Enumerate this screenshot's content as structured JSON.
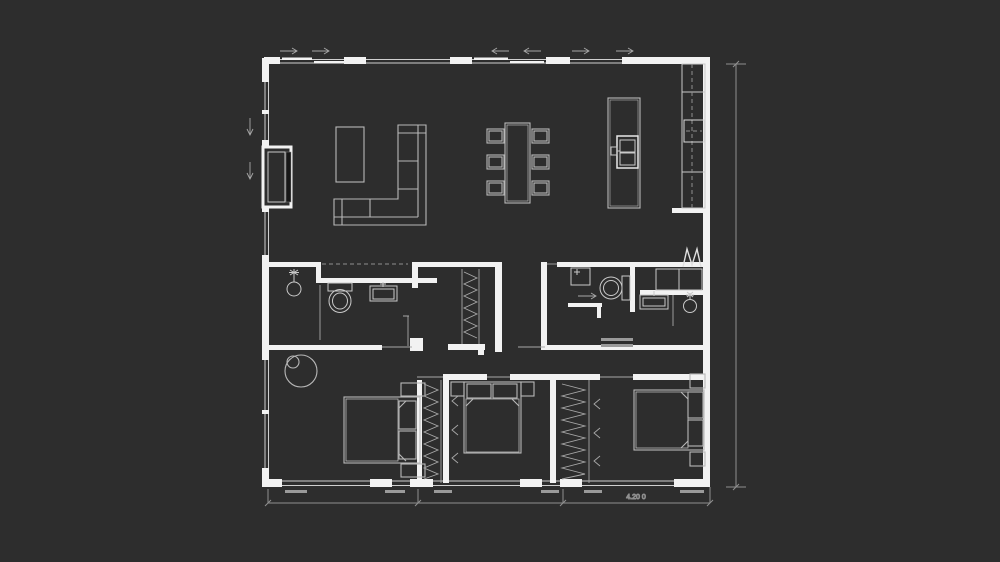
{
  "canvas": {
    "width": 1000,
    "height": 562,
    "background": "#2d2d2d"
  },
  "palette": {
    "wall": "#f2f2f2",
    "window_line": "#cfcfcf",
    "furniture_line": "#b8b8b8",
    "fixture_line": "#c9c9c9",
    "dimension_line": "#8f8f8f",
    "dark_inset": "#171717"
  },
  "annotation": {
    "bottom_dimension_label": "4.20 0"
  },
  "plan": {
    "type": "floor-plan",
    "rooms": [
      {
        "name": "living-dining-kitchen",
        "items": [
          "l-shaped-sofa",
          "coffee-table",
          "fireplace",
          "dining-table",
          "six-dining-chairs",
          "kitchen-island-with-sink",
          "kitchen-counter-with-cooktop"
        ]
      },
      {
        "name": "bathroom-1",
        "items": [
          "shower-head",
          "toilet",
          "washbasin",
          "hall-closet"
        ]
      },
      {
        "name": "bathroom-2-laundry",
        "items": [
          "vanity-cabinet",
          "toilet",
          "wall-cabinets",
          "laundry-sink",
          "shower-head",
          "drying-rack"
        ]
      },
      {
        "name": "bedroom-1",
        "items": [
          "double-bed",
          "two-nightstands",
          "plant",
          "wardrobe"
        ]
      },
      {
        "name": "bedroom-2",
        "items": [
          "double-bed",
          "two-nightstands",
          "wardrobe"
        ]
      },
      {
        "name": "bedroom-3",
        "items": [
          "double-bed",
          "two-nightstands"
        ]
      }
    ]
  }
}
